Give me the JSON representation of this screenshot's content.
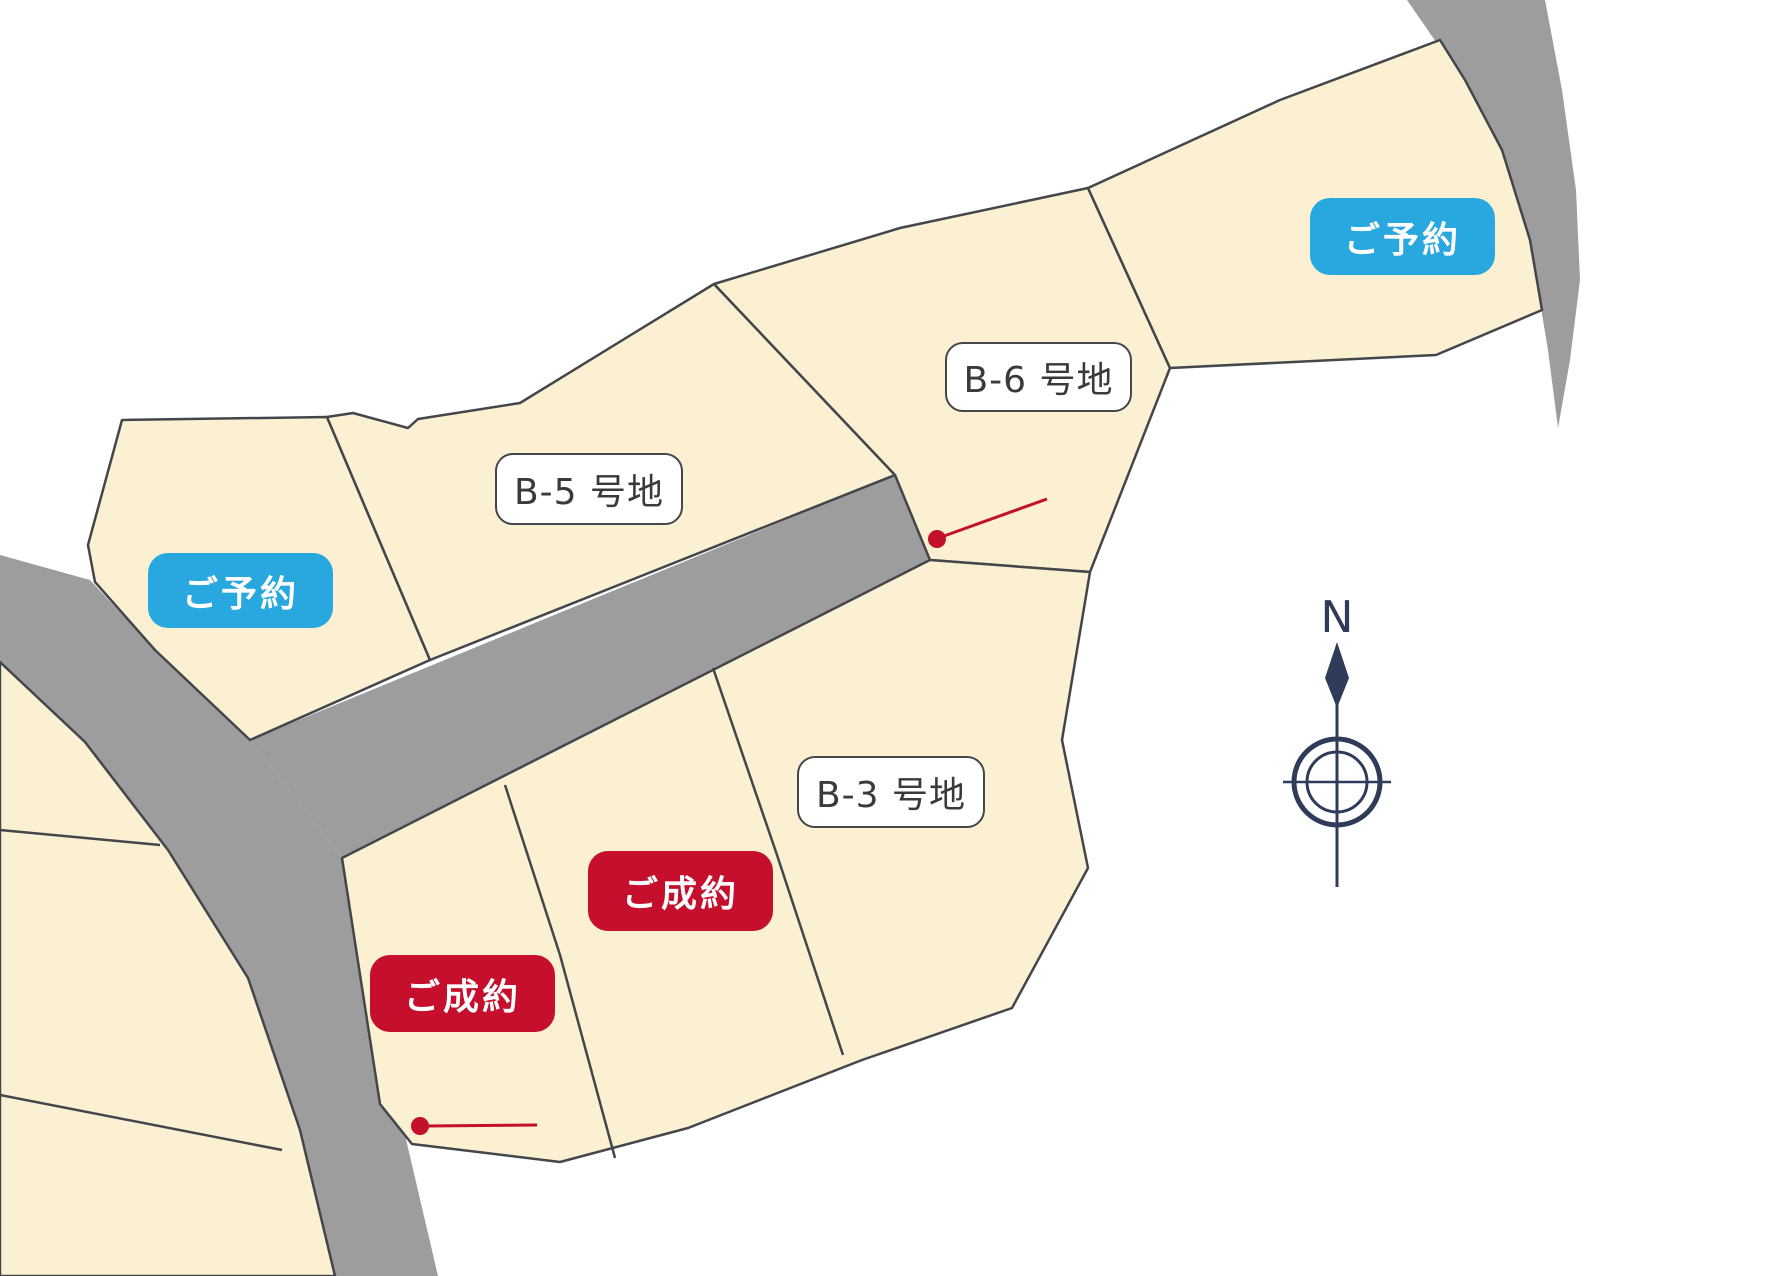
{
  "map": {
    "type": "land-subdivision-plan",
    "lot_labels": {
      "b5": "B-5 号地",
      "b6": "B-6 号地",
      "b3": "B-3 号地"
    },
    "status_badges": {
      "reserved_west": "ご予約",
      "reserved_east": "ご予約",
      "sold_upper": "ご成約",
      "sold_lower": "ご成約"
    },
    "compass": {
      "north": "N"
    },
    "colors": {
      "lot_fill": "#fcf0d3",
      "road_fill": "#9d9d9d",
      "lot_outline": "#43464b",
      "reserved_blue": "#29a8e0",
      "sold_red": "#c50f2d",
      "marker_red": "#c3112c",
      "compass_navy": "#2e3c5a",
      "label_bg": "#ffffff",
      "label_text": "#3a3a3a"
    }
  }
}
